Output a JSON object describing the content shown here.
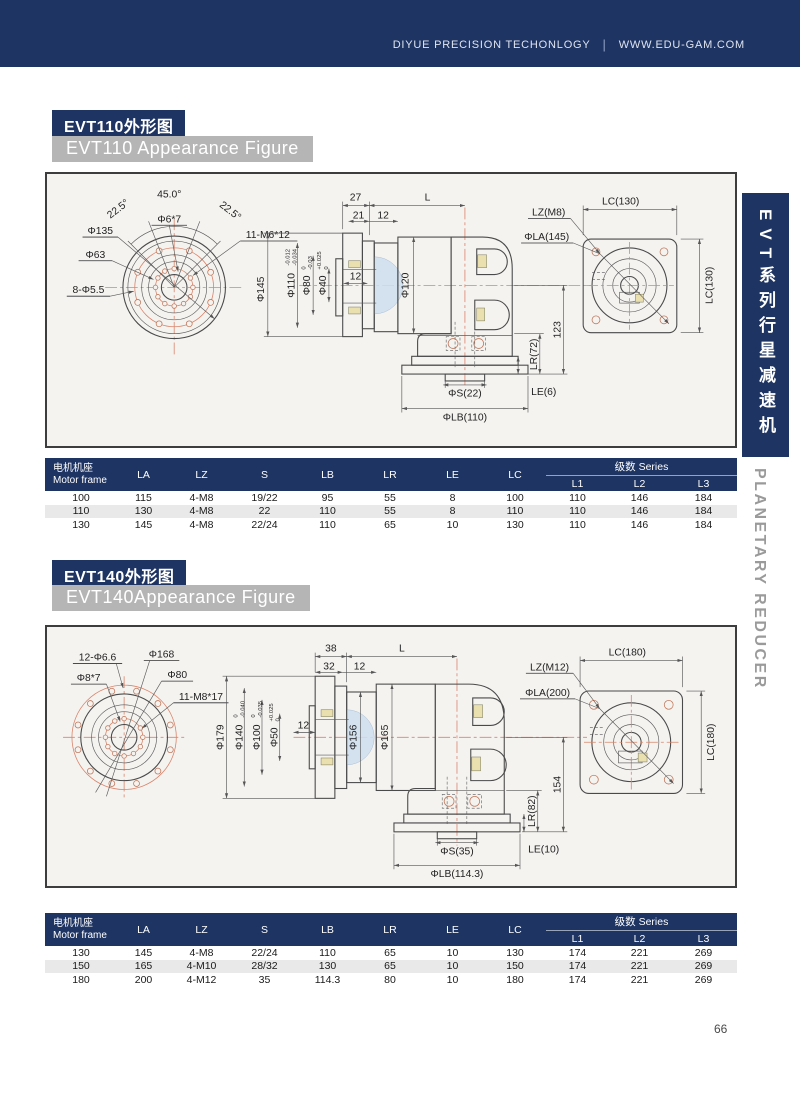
{
  "header": {
    "company": "DIYUE PRECISION TECHONLOGY",
    "divider": "|",
    "website": "WWW.EDU-GAM.COM"
  },
  "sidebar": {
    "tab_cn": "EVT系列行星减速机",
    "tab_en": "PLANETARY REDUCER"
  },
  "page": {
    "number": "66"
  },
  "s1": {
    "title_cn": "EVT110外形图",
    "title_en": "EVT110 Appearance Figure",
    "front": {
      "angle_top": "45.0°",
      "angle_left": "22.5°",
      "angle_right": "22.5°",
      "key": "Φ6*7",
      "bolt_circle": "Φ135",
      "inner": "Φ63",
      "holes": "8-Φ5.5",
      "taps": "11-M6*12"
    },
    "side": {
      "flange": "Φ145",
      "d1": "Φ110",
      "d1t": "-0.012",
      "d1b": "-0.034",
      "d2": "Φ80",
      "d2t": "0",
      "d2b": "-0.03",
      "d3": "Φ40",
      "d3t": "+0.025",
      "d3b": "0",
      "key_w": "12",
      "body": "Φ120",
      "a": "27",
      "b": "21",
      "c": "12",
      "L": "L",
      "s": "ΦS(22)",
      "lb": "ΦLB(110)",
      "h": "123",
      "lr": "LR(72)",
      "le": "LE(6)"
    },
    "flange_view": {
      "lc_top": "LC(130)",
      "lc_side": "LC(130)",
      "lz": "LZ(M8)",
      "la": "ΦLA(145)"
    }
  },
  "s2": {
    "title_cn": "EVT140外形图",
    "title_en": "EVT140Appearance Figure",
    "front": {
      "holes": "12-Φ6.6",
      "outer": "Φ168",
      "key": "Φ8*7",
      "inner": "Φ80",
      "taps": "11-M8*17"
    },
    "side": {
      "flange": "Φ179",
      "d1": "Φ140",
      "d1t": "0",
      "d1b": "-0.040",
      "d2": "Φ100",
      "d2t": "0",
      "d2b": "-0.035",
      "d3": "Φ50",
      "d3t": "+0.025",
      "d3b": "0",
      "key_w": "12",
      "body1": "Φ156",
      "body2": "Φ165",
      "a": "38",
      "b": "32",
      "c": "12",
      "L": "L",
      "s": "ΦS(35)",
      "lb": "ΦLB(114.3)",
      "h": "154",
      "lr": "LR(82)",
      "le": "LE(10)"
    },
    "flange_view": {
      "lc_top": "LC(180)",
      "lc_side": "LC(180)",
      "lz": "LZ(M12)",
      "la": "ΦLA(200)"
    }
  },
  "table_header": {
    "motor_cn": "电机机座",
    "motor_en": "Motor frame",
    "cols": [
      "LA",
      "LZ",
      "S",
      "LB",
      "LR",
      "LE",
      "LC"
    ],
    "series": "级数  Series",
    "series_cols": [
      "L1",
      "L2",
      "L3"
    ]
  },
  "table1": {
    "rows": [
      [
        "100",
        "115",
        "4-M8",
        "19/22",
        "95",
        "55",
        "8",
        "100",
        "110",
        "146",
        "184"
      ],
      [
        "110",
        "130",
        "4-M8",
        "22",
        "110",
        "55",
        "8",
        "110",
        "110",
        "146",
        "184"
      ],
      [
        "130",
        "145",
        "4-M8",
        "22/24",
        "110",
        "65",
        "10",
        "130",
        "110",
        "146",
        "184"
      ]
    ]
  },
  "table2": {
    "rows": [
      [
        "130",
        "145",
        "4-M8",
        "22/24",
        "110",
        "65",
        "10",
        "130",
        "174",
        "221",
        "269"
      ],
      [
        "150",
        "165",
        "4-M10",
        "28/32",
        "130",
        "65",
        "10",
        "150",
        "174",
        "221",
        "269"
      ],
      [
        "180",
        "200",
        "4-M12",
        "35",
        "114.3",
        "80",
        "10",
        "180",
        "174",
        "221",
        "269"
      ]
    ]
  }
}
